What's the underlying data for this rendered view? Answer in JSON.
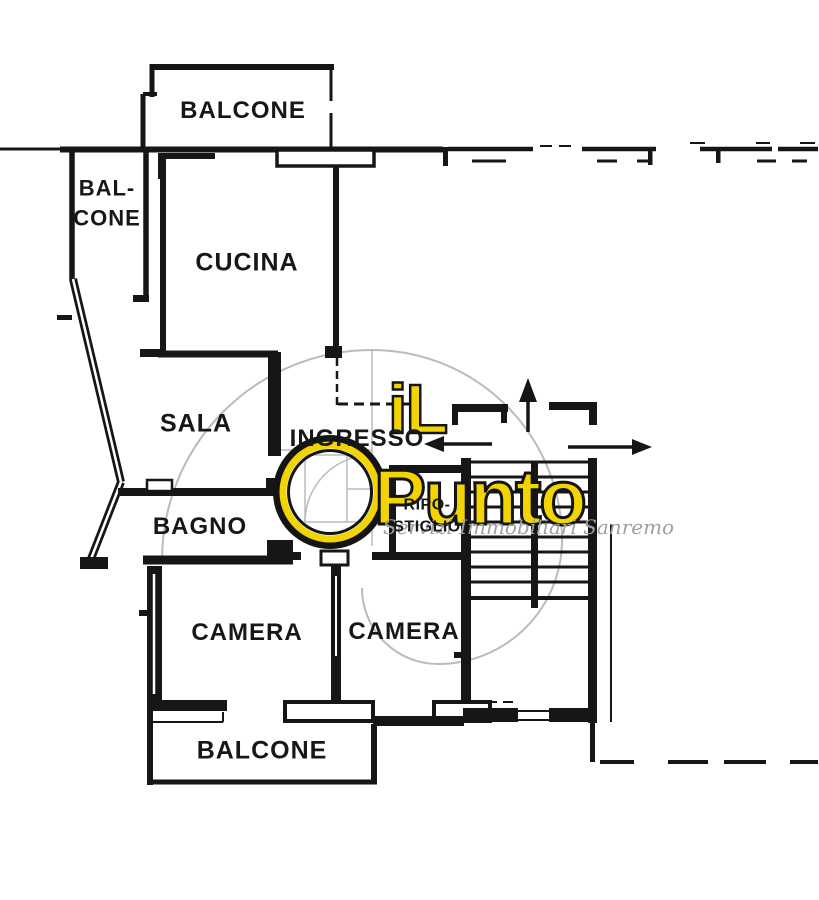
{
  "plan": {
    "title": "apartment floor plan",
    "background_color": "#FFFFFF",
    "wall_color": "#161616"
  },
  "rooms": {
    "balcone_top": {
      "label": "BALCONE"
    },
    "balcone_left": {
      "label_lines": [
        "BAL-",
        "CONE"
      ]
    },
    "cucina": {
      "label": "CUCINA"
    },
    "sala": {
      "label": "SALA"
    },
    "ingresso": {
      "label": "INGRESSO"
    },
    "bagno": {
      "label": "BAGNO"
    },
    "ripostiglio": {
      "label_lines": [
        "RIPO-",
        "STIGLIO"
      ]
    },
    "camera_left": {
      "label": "CAMERA"
    },
    "camera_right": {
      "label": "CAMERA"
    },
    "balcone_bottom": {
      "label": "BALCONE"
    }
  },
  "watermark": {
    "brand_word1": "iL",
    "brand_word2": "Punto",
    "tagline": "Servizi Immobiliari Sanremo",
    "brand_color": "#F3D403",
    "spiral_color": "#BBBBBB",
    "tagline_color": "#9F9F9F"
  },
  "icons": {
    "arrow_up": "↑",
    "arrow_left": "←",
    "arrow_right": "→"
  }
}
